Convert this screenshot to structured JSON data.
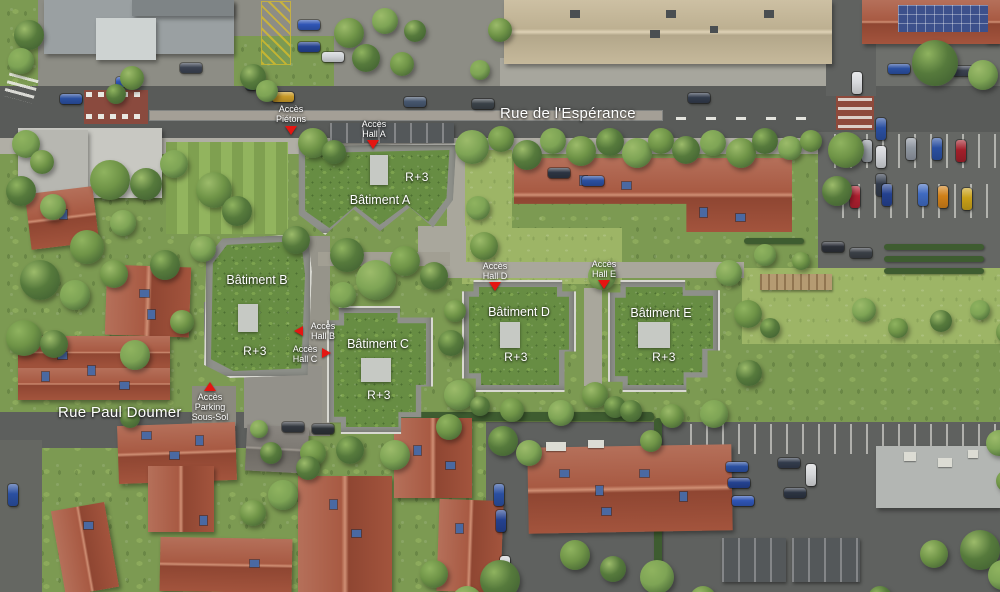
{
  "streets": {
    "esperance": "Rue de l'Espérance",
    "paul_doumer": "Rue Paul Doumer"
  },
  "buildings": [
    {
      "name": "Bâtiment A",
      "floors": "R+3"
    },
    {
      "name": "Bâtiment B",
      "floors": "R+3"
    },
    {
      "name": "Bâtiment C",
      "floors": "R+3"
    },
    {
      "name": "Bâtiment D",
      "floors": "R+3"
    },
    {
      "name": "Bâtiment E",
      "floors": "R+3"
    }
  ],
  "access": {
    "pietons": {
      "line1": "Accès",
      "line2": "Piétons"
    },
    "hall_a": {
      "line1": "Accès",
      "line2": "Hall A"
    },
    "hall_b": {
      "line1": "Accès",
      "line2": "Hall B"
    },
    "hall_c": {
      "line1": "Accès",
      "line2": "Hall C"
    },
    "hall_d": {
      "line1": "Accès",
      "line2": "Hall D"
    },
    "hall_e": {
      "line1": "Accès",
      "line2": "Hall E"
    },
    "parking_sous_sol": {
      "line1": "Accès",
      "line2": "Parking",
      "line3": "Sous-Sol"
    }
  },
  "colors": {
    "marker_red": "#e41511",
    "label_white": "#ffffff",
    "green_roof": "#678d43",
    "terracotta": "#a85a43",
    "asphalt": "#595b59"
  }
}
